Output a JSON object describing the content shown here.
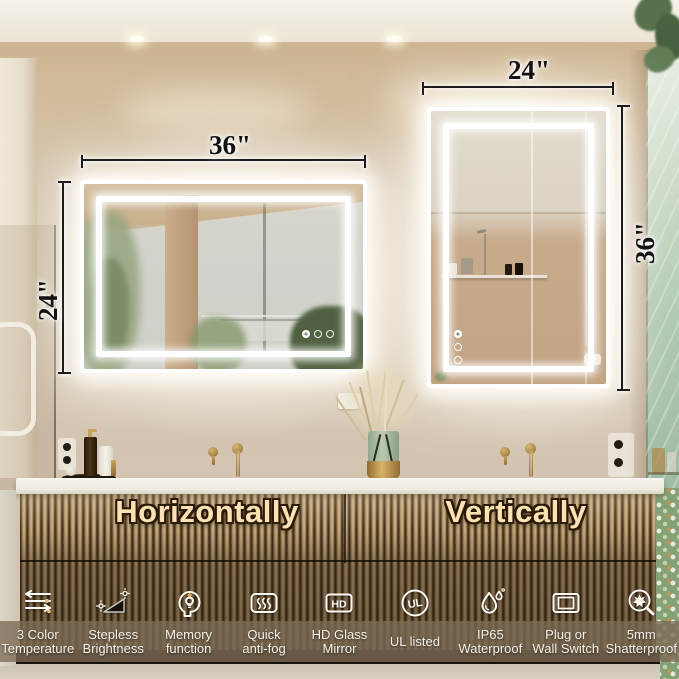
{
  "dimensions": {
    "horizontal_mirror": {
      "width": "36\"",
      "height": "24\""
    },
    "vertical_mirror": {
      "width": "24\"",
      "height": "36\""
    }
  },
  "captions": {
    "horizontal": "Horizontally",
    "vertical": "Vertically"
  },
  "features": [
    {
      "icon": "color-temperature-icon",
      "line1": "3 Color",
      "line2": "Temperature"
    },
    {
      "icon": "stepless-brightness-icon",
      "line1": "Stepless",
      "line2": "Brightness"
    },
    {
      "icon": "memory-function-icon",
      "line1": "Memory",
      "line2": "function"
    },
    {
      "icon": "anti-fog-icon",
      "line1": "Quick",
      "line2": "anti-fog"
    },
    {
      "icon": "hd-glass-icon",
      "line1": "HD Glass",
      "line2": "Mirror",
      "icon_text": "HD"
    },
    {
      "icon": "ul-listed-icon",
      "line1": "UL listed",
      "line2": "",
      "icon_text": "UL"
    },
    {
      "icon": "waterproof-icon",
      "line1": "IP65",
      "line2": "Waterproof"
    },
    {
      "icon": "plug-switch-icon",
      "line1": "Plug or",
      "line2": "Wall Switch"
    },
    {
      "icon": "shatterproof-icon",
      "line1": "5mm",
      "line2": "Shatterproof"
    }
  ],
  "colors": {
    "wall": "#d3c5b2",
    "soffit": "#cdb592",
    "counter": "#f3f1ea",
    "cabinet_wood": "#b59a70",
    "caption_text": "#fce1b4",
    "caption_band": "rgba(124,108,86,0.78)",
    "led_glow": "#ffffff",
    "brass": "#c8a257",
    "dimension_text": "#121212",
    "feature_text": "#f7f2e9",
    "shower_glass": "#aec8b1"
  }
}
